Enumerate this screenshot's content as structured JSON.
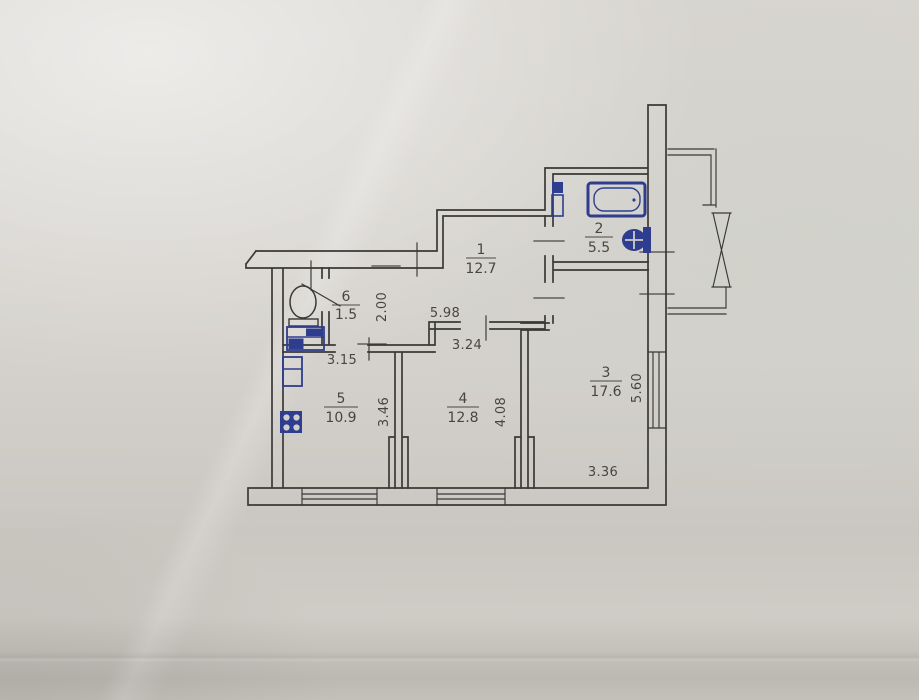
{
  "document": {
    "type_label": "apartment-floor-plan-photograph"
  },
  "rooms": [
    {
      "number": "1",
      "area": "12.7"
    },
    {
      "number": "2",
      "area": "5.5"
    },
    {
      "number": "3",
      "area": "17.6"
    },
    {
      "number": "4",
      "area": "12.8"
    },
    {
      "number": "5",
      "area": "10.9"
    },
    {
      "number": "6",
      "area": "1.5"
    }
  ],
  "dimensions": [
    {
      "value": "2.00",
      "orientation": "vertical"
    },
    {
      "value": "5.98",
      "orientation": "horizontal"
    },
    {
      "value": "3.24",
      "orientation": "horizontal"
    },
    {
      "value": "3.15",
      "orientation": "horizontal"
    },
    {
      "value": "3.46",
      "orientation": "vertical"
    },
    {
      "value": "4.08",
      "orientation": "vertical"
    },
    {
      "value": "3.36",
      "orientation": "horizontal"
    },
    {
      "value": "5.60",
      "orientation": "vertical"
    }
  ],
  "fixtures": [
    "bathtub-icon",
    "washbasin-icon",
    "water-heater-icon",
    "toilet-icon",
    "vanity-cabinet-icon",
    "refrigerator-icon",
    "stove-4-burner-icon"
  ],
  "features": {
    "windows_count": 3,
    "balcony": true
  },
  "colors": {
    "paper": "#d3d0cb",
    "ink": "#3b3936",
    "fixture_blue": "#2e3d8e",
    "text": "#35332f"
  }
}
